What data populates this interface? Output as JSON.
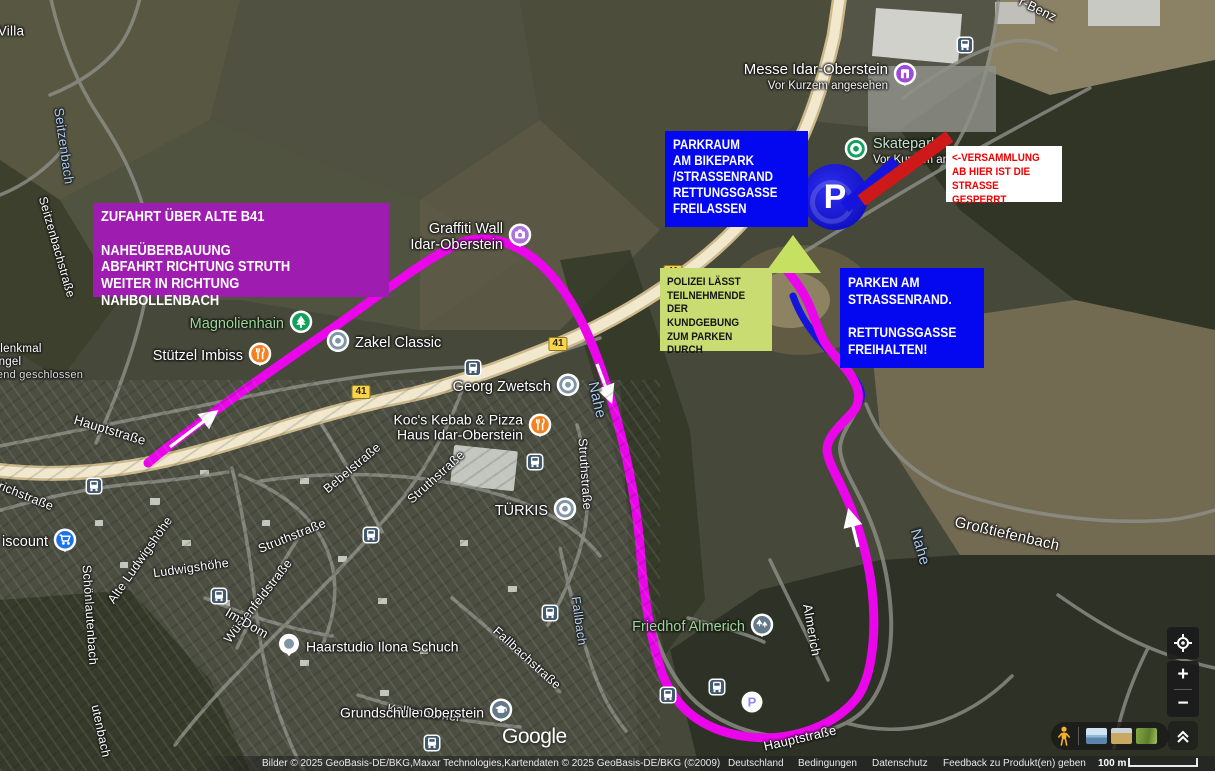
{
  "annotations": {
    "route_info_box": {
      "text": "ZUFAHRT ÜBER ALTE B41\n\nNAHEÜBERBAUUNG\nABFAHRT RICHTUNG STRUTH\nWEITER IN RICHTUNG NAHBOLLENBACH",
      "bg": "#9e1cb0",
      "fg": "#ffffff"
    },
    "parkraum_box": {
      "text": "PARKRAUM\nAM BIKEPARK\n/STRASSENRAND\nRETTUNGSGASSE\nFREILASSEN",
      "bg": "#0408f0",
      "fg": "#ffffff"
    },
    "versammlung_box": {
      "text": "<-VERSAMMLUNG\nAB HIER IST DIE\nSTRASSE GESPERRT",
      "bg": "#ffffff",
      "fg": "#ef0000"
    },
    "polizei_box": {
      "text": "POLIZEI LÄSST\nTEILNEHMENDE\nDER KUNDGEBUNG\nZUM PARKEN DURCH",
      "bg": "#c9dc72",
      "fg": "#141414"
    },
    "parken_box": {
      "text": "PARKEN AM\nSTRASSENRAND.\n\nRETTUNGSGASSE\nFREIHALTEN!",
      "bg": "#0408f0",
      "fg": "#ffffff"
    },
    "route_color": "#ea05eb",
    "parking_line_color": "#1414dd",
    "closed_line_color": "#cd1919",
    "assembly_marker_color": "#c6e062"
  },
  "map": {
    "big_marker": {
      "letter": "P",
      "x": 835,
      "y": 197
    },
    "labels": [
      {
        "t": "Villa",
        "x": 11,
        "y": 31,
        "r": 0,
        "s": 13.5
      },
      {
        "t": "lenkmal",
        "x": 21,
        "y": 349,
        "r": 0,
        "s": 11.5
      },
      {
        "t": "ngel",
        "x": 10,
        "y": 362,
        "r": 0,
        "s": 11.5
      },
      {
        "t": "end geschlossen",
        "x": 40,
        "y": 375,
        "r": 0,
        "s": 11,
        "c": "#d9d9d9"
      },
      {
        "t": "Seitzenbach",
        "x": 64,
        "y": 146,
        "r": 82,
        "s": 13.5,
        "c": "#a9c9ef"
      },
      {
        "t": "Seitzenbachstraße",
        "x": 57,
        "y": 247,
        "r": 74,
        "s": 12
      },
      {
        "t": "richstraße",
        "x": 26,
        "y": 496,
        "r": 22,
        "s": 12.5
      },
      {
        "t": "Hauptstraße",
        "x": 110,
        "y": 430,
        "r": 17,
        "s": 13
      },
      {
        "t": "Schönlautenbach",
        "x": 90,
        "y": 615,
        "r": 86,
        "s": 12.5
      },
      {
        "t": "utenbach",
        "x": 101,
        "y": 731,
        "r": 78,
        "s": 12.5
      },
      {
        "t": "Alte Ludwigshöhe",
        "x": 140,
        "y": 560,
        "r": -55,
        "s": 12.5
      },
      {
        "t": "Ludwigshöhe",
        "x": 191,
        "y": 568,
        "r": -8,
        "s": 12.5
      },
      {
        "t": "Struthstraße",
        "x": 436,
        "y": 477,
        "r": -42,
        "s": 12.5
      },
      {
        "t": "Struthstraße",
        "x": 585,
        "y": 474,
        "r": 86,
        "s": 12.5
      },
      {
        "t": "Struthstraße",
        "x": 292,
        "y": 536,
        "r": -22,
        "s": 12.5
      },
      {
        "t": "Bebelstraße",
        "x": 352,
        "y": 468,
        "r": -40,
        "s": 12.5
      },
      {
        "t": "Wüstenfeldstraße",
        "x": 258,
        "y": 601,
        "r": -52,
        "s": 12.5
      },
      {
        "t": "Im Dom",
        "x": 247,
        "y": 623,
        "r": 30,
        "s": 13
      },
      {
        "t": "Fallbachstraße",
        "x": 527,
        "y": 658,
        "r": 42,
        "s": 12.5
      },
      {
        "t": "Fallbach",
        "x": 579,
        "y": 621,
        "r": 82,
        "s": 12.5,
        "c": "#b9d4ee"
      },
      {
        "t": "Kallenborner",
        "x": 424,
        "y": 713,
        "r": 7,
        "s": 12.5
      },
      {
        "t": "Hauptstraße",
        "x": 800,
        "y": 738,
        "r": -13,
        "s": 13
      },
      {
        "t": "Almerich",
        "x": 812,
        "y": 630,
        "r": 80,
        "s": 13
      },
      {
        "t": "Nahe",
        "x": 597,
        "y": 400,
        "r": 77,
        "s": 15,
        "c": "#a9c9ef"
      },
      {
        "t": "Nahe",
        "x": 920,
        "y": 547,
        "r": 74,
        "s": 15,
        "c": "#a9c9ef"
      },
      {
        "t": "Großtiefenbach",
        "x": 1007,
        "y": 534,
        "r": 13,
        "s": 15
      },
      {
        "t": "r-Benz",
        "x": 1038,
        "y": 9,
        "r": 26,
        "s": 13
      }
    ],
    "pois": [
      {
        "name": "Messe Idar-Oberstein",
        "sub": "Vor Kurzem angesehen",
        "icon": "building",
        "color": "#9c4ad8",
        "x": 905,
        "y": 77,
        "side": "left",
        "ns": 15
      },
      {
        "name": "Skatepark",
        "sub": "Vor Kurzem an",
        "icon": "donut",
        "color": "#12a05c",
        "x": 856,
        "y": 152,
        "side": "right",
        "nc": "#bfe3c8",
        "ns": 14.5
      },
      {
        "name": "Graffiti Wall\nIdar-Oberstein",
        "icon": "camera",
        "color": "#ae72dc",
        "x": 520,
        "y": 238,
        "side": "left",
        "ns": 14.5
      },
      {
        "name": "Magnolienhain",
        "icon": "tree",
        "color": "#12a05c",
        "x": 301,
        "y": 325,
        "side": "left",
        "nc": "#9bd795",
        "ns": 14.5
      },
      {
        "name": "Stützel Imbiss",
        "icon": "food",
        "color": "#f48222",
        "x": 260,
        "y": 357,
        "side": "left",
        "ns": 14.5
      },
      {
        "name": "Zakel Classic",
        "icon": "donut",
        "color": "#8096a6",
        "x": 338,
        "y": 344,
        "side": "right",
        "ns": 14.5
      },
      {
        "name": "Georg Zwetsch",
        "icon": "donut",
        "color": "#8096a6",
        "x": 568,
        "y": 388,
        "side": "left",
        "ns": 14.5
      },
      {
        "name": "Koc's Kebab & Pizza\nHaus Idar-Oberstein",
        "icon": "food",
        "color": "#f48222",
        "x": 540,
        "y": 428,
        "side": "left",
        "ns": 14
      },
      {
        "name": "TÜRKIS",
        "icon": "donut",
        "color": "#8096a6",
        "x": 565,
        "y": 512,
        "side": "left",
        "ns": 14.5
      },
      {
        "name": "Haarstudio Ilona Schuch",
        "icon": "dotrev",
        "color": "#8096a6",
        "x": 289,
        "y": 647,
        "side": "right",
        "ns": 14
      },
      {
        "name": "Grundschule Oberstein",
        "icon": "school",
        "color": "#637889",
        "x": 501,
        "y": 713,
        "side": "left",
        "ns": 14
      },
      {
        "name": "Friedhof Almerich",
        "icon": "cemetery",
        "color": "#637889",
        "x": 762,
        "y": 628,
        "side": "left",
        "nc": "#9bd795",
        "ns": 14.5
      },
      {
        "name": "iscount",
        "icon": "cart",
        "color": "#1a73e8",
        "x": 65,
        "y": 543,
        "side": "left",
        "ns": 14.5
      }
    ],
    "shields": [
      {
        "label": "41",
        "x": 558,
        "y": 344
      },
      {
        "label": "41",
        "x": 361,
        "y": 392
      },
      {
        "label": "41",
        "x": 673,
        "y": 272
      }
    ],
    "transit": [
      {
        "x": 965,
        "y": 45
      },
      {
        "x": 473,
        "y": 368
      },
      {
        "x": 94,
        "y": 486
      },
      {
        "x": 219,
        "y": 596
      },
      {
        "x": 371,
        "y": 535
      },
      {
        "x": 535,
        "y": 462
      },
      {
        "x": 550,
        "y": 613
      },
      {
        "x": 432,
        "y": 743
      },
      {
        "x": 668,
        "y": 695
      },
      {
        "x": 717,
        "y": 687
      }
    ],
    "parking": [
      {
        "label": "P",
        "x": 752,
        "y": 702
      }
    ]
  },
  "footer": {
    "attribution": "Bilder © 2025 GeoBasis-DE/BKG,Maxar Technologies,Kartendaten © 2025 GeoBasis-DE/BKG (©2009)",
    "links": [
      "Deutschland",
      "Bedingungen",
      "Datenschutz",
      "Feedback zu Produkt(en) geben"
    ],
    "scale_label": "100 m",
    "logo": "Google"
  },
  "controls": {
    "zoom_in": "+",
    "zoom_out": "−"
  }
}
